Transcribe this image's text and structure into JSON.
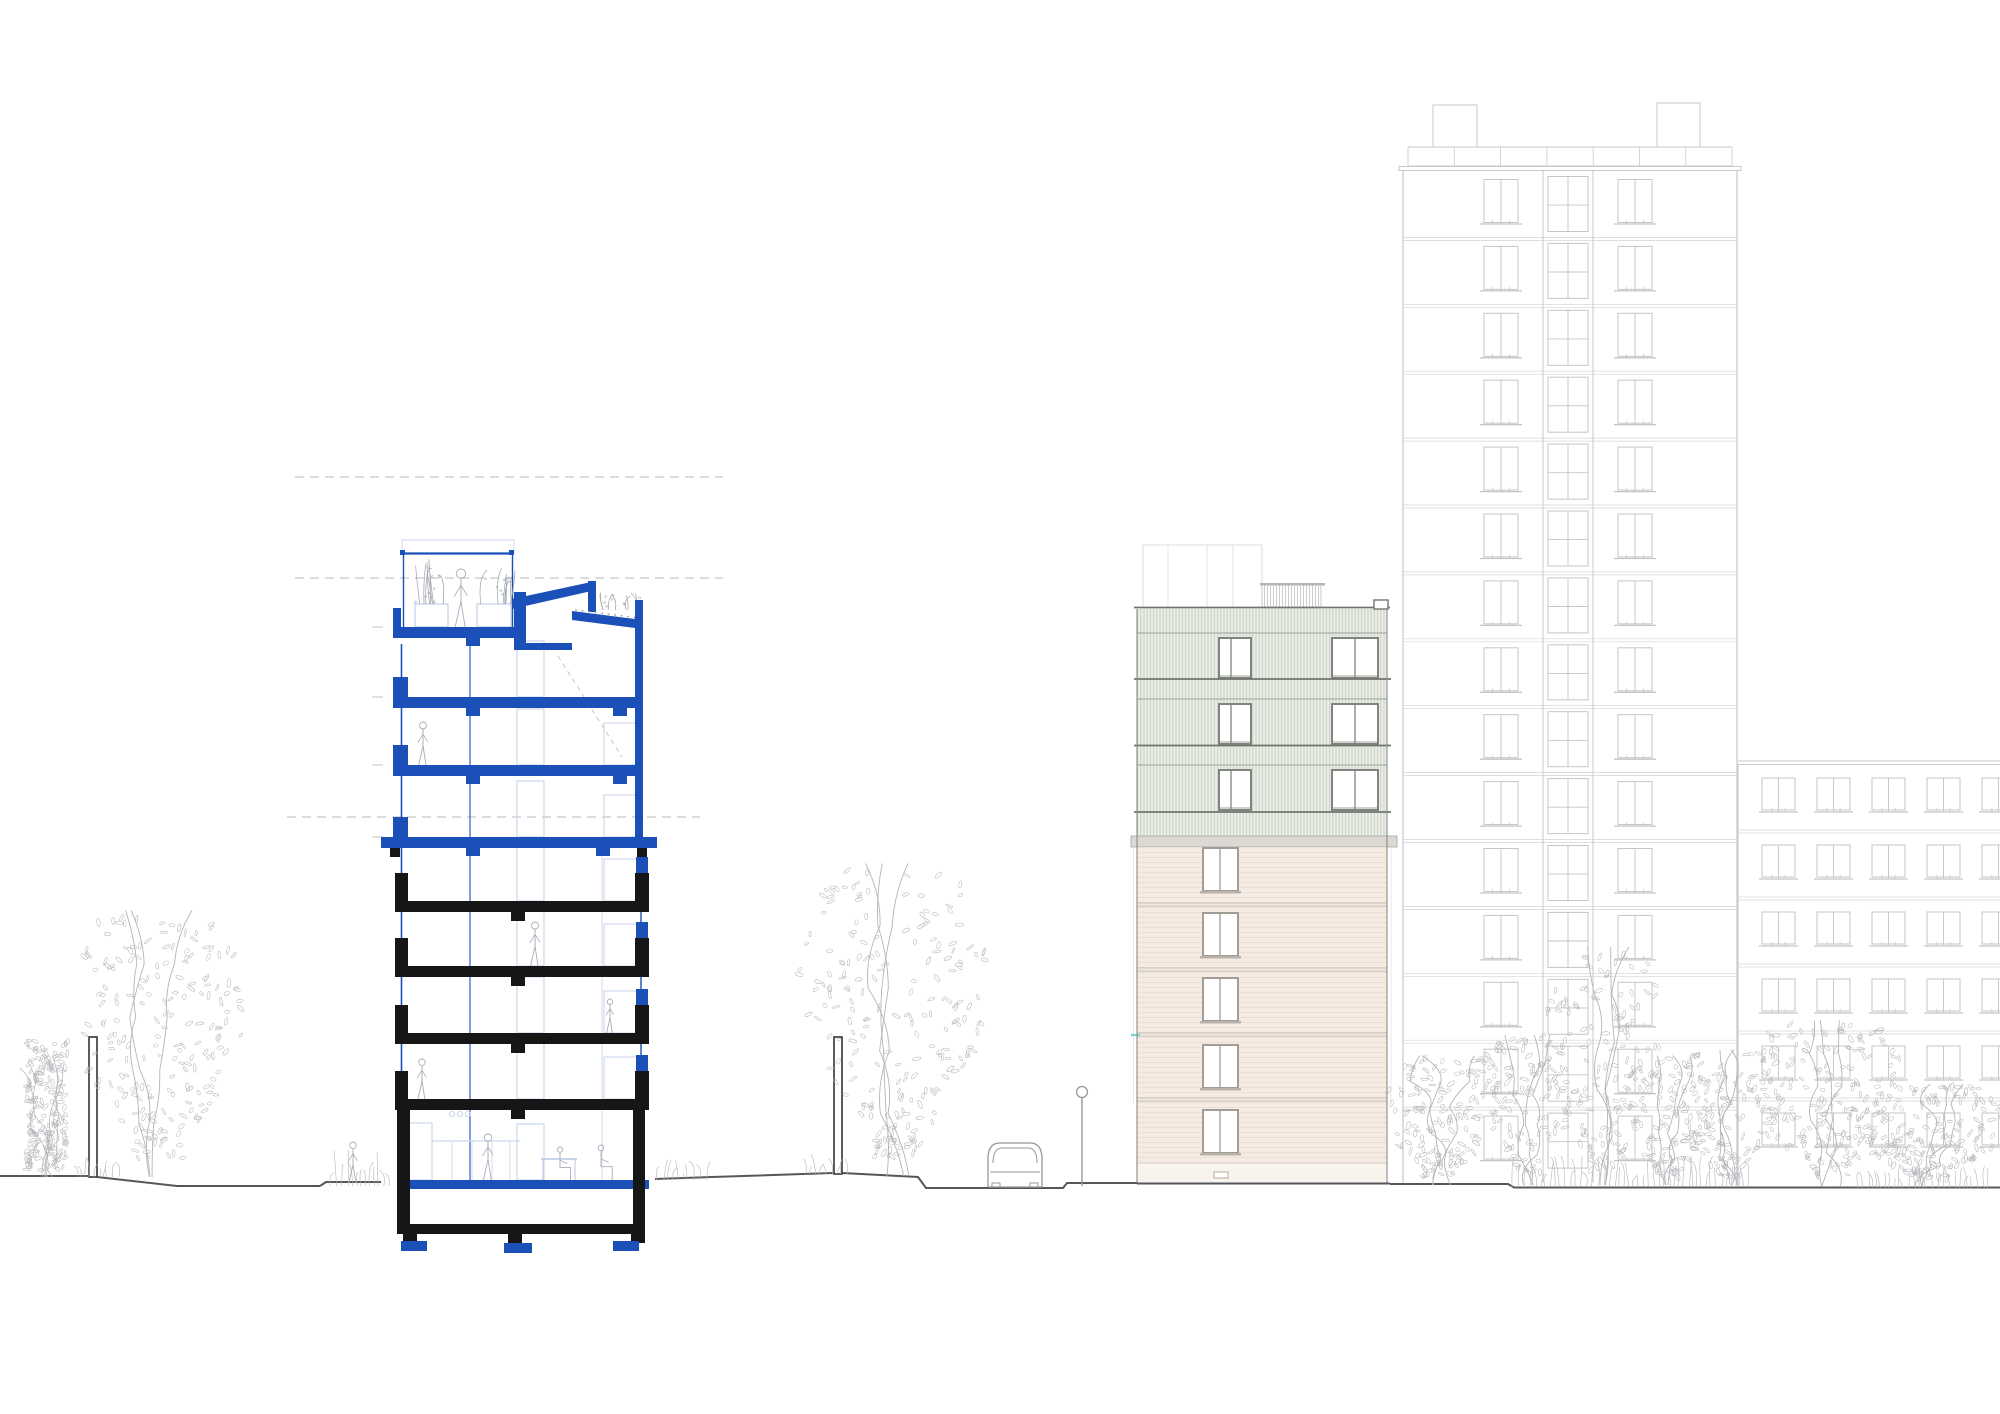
{
  "image": {
    "width": 2000,
    "height": 1414,
    "background": "#ffffff",
    "description": "Architectural drawing: residential cross-section (blue new floors over black existing floors) and street elevation with tower, extension building and landscape"
  },
  "palette": {
    "blue": "#1a50b8",
    "blueLight": "#ccd7ec",
    "blueMid": "#b9c6e0",
    "black": "#161616",
    "dash": "#c7c7c9",
    "tick": "#c3c3c5",
    "sketch": "#b2b5b9",
    "figure": "#a9aeb6",
    "ground": "#55575b",
    "post": "#3e4044",
    "vehicle": "#97989c",
    "towerLine": "#c9c9cd",
    "towerFloor": "#d4d4d8",
    "towerWin": "#c5c5c9",
    "greenFill": "#ecefe8",
    "greenHatch": "#c3cdbe",
    "greenLine": "#70746e",
    "greenHead": "#9ba199",
    "greenFrame": "#80847e",
    "beigeFill": "#f5ebe3",
    "beigeSiding": "#ebdfd5",
    "beigeFloor": "#c6c0b9",
    "beigeFrame": "#a29c96",
    "beigeSill": "#b8b2ab",
    "baseFill": "#f8f3ed",
    "baseLine": "#d8d2cb",
    "cornice": "#dcd8d3",
    "corniceEdge": "#a8a49f",
    "outline": "#8e8a85",
    "penthouse": "#c9c9cc",
    "faint": "#dddde0",
    "guide": "#e4e7ee",
    "cyan": "#7ed0cc"
  },
  "datum": {
    "lines": [
      {
        "y": 477,
        "x0": 295,
        "x1": 723
      },
      {
        "y": 578,
        "x0": 295,
        "x1": 723
      },
      {
        "y": 817,
        "x0": 287,
        "x1": 700
      }
    ],
    "ticks": {
      "x0": 372,
      "x1": 383,
      "ys": [
        627,
        697,
        765,
        837
      ]
    }
  },
  "section": {
    "left": 397,
    "right": 649,
    "slab_t": 11,
    "face_left_x": 401.5,
    "face_left_y": [
      644,
      1110
    ],
    "inner_blue_x": 470,
    "inner_blue_y": [
      638,
      1180
    ],
    "inner_light_x": 602,
    "inner_light_y": [
      848,
      1180
    ],
    "face_right_x": 641,
    "face_right_y": [
      848,
      1180
    ],
    "blue_slabs": [
      697,
      765
    ],
    "wide_blue_slab": [
      381,
      837,
      276,
      11
    ],
    "black_slabs": [
      901,
      966,
      1033,
      1099
    ],
    "interiors": [
      [
        644,
        697
      ],
      [
        708,
        765
      ],
      [
        776,
        837
      ],
      [
        848,
        901
      ],
      [
        912,
        966
      ],
      [
        977,
        1033
      ],
      [
        1044,
        1099
      ],
      [
        1110,
        1180
      ]
    ],
    "door": {
      "x": 517,
      "w": 27,
      "h": 56
    },
    "furniture": {
      "x": 604,
      "w": 36,
      "h": 42
    },
    "terrace": {
      "outline": [
        402,
        540,
        112,
        13
      ],
      "rail_y": 553.5,
      "rail_x": [
        402,
        514
      ],
      "posts": [
        [
          400,
          550
        ],
        [
          509,
          550
        ]
      ],
      "verticals": [
        403.5,
        512.5
      ],
      "vert_y": [
        555,
        627
      ],
      "slab": [
        393,
        627,
        124,
        11
      ],
      "upstand": [
        393,
        608,
        8,
        19
      ],
      "planters": [
        [
          415,
          604,
          33,
          23
        ],
        [
          477,
          604,
          34,
          23
        ]
      ],
      "plant_seed": 31
    },
    "bulkhead": {
      "wall": [
        514,
        592,
        12,
        58
      ],
      "roof": [
        [
          512,
          599
        ],
        [
          596,
          581
        ],
        [
          596,
          590
        ],
        [
          512,
          609
        ]
      ],
      "tab": [
        588,
        581,
        8,
        31
      ],
      "floor": [
        526,
        643,
        46,
        7
      ]
    },
    "green_roof": {
      "poly": [
        [
          572,
          611
        ],
        [
          643,
          620
        ],
        [
          643,
          629
        ],
        [
          572,
          620
        ]
      ],
      "parapet": [
        635,
        600,
        8,
        28
      ],
      "column": [
        635,
        612,
        8,
        236
      ],
      "plant_seed": 32
    },
    "under_terrace_stub": [
      466,
      638,
      14,
      8
    ],
    "blue_stub_x": [
      466,
      613
    ],
    "wide_slab_pads_black": [
      [
        390,
        848,
        10,
        9
      ],
      [
        637,
        848,
        10,
        9
      ]
    ],
    "wide_slab_stubs_blue": [
      [
        466,
        848,
        14,
        8
      ],
      [
        596,
        848,
        14,
        8
      ]
    ],
    "ground_slab": [
      397,
      1180,
      252,
      9
    ],
    "basement": {
      "lwall": [
        397,
        1110,
        13,
        123
      ],
      "rwall": [
        633,
        1110,
        12,
        123
      ],
      "slab": [
        397,
        1224,
        248,
        10
      ],
      "stubs": [
        [
          403,
          1233,
          14,
          10
        ],
        [
          508,
          1233,
          14,
          12
        ],
        [
          631,
          1233,
          14,
          10
        ]
      ],
      "pads": [
        [
          401,
          1241,
          26,
          10
        ],
        [
          504,
          1243,
          28,
          10
        ],
        [
          613,
          1241,
          26,
          10
        ]
      ]
    },
    "kitchen": {
      "fridge": [
        406,
        1123,
        26,
        57
      ],
      "counter_y": 1141,
      "counter_x": [
        432,
        520
      ],
      "verts": [
        452,
        472,
        492,
        510
      ],
      "circles": [
        [
          452,
          1114
        ],
        [
          460,
          1114
        ],
        [
          468,
          1114
        ]
      ],
      "table": {
        "x0": 541,
        "x1": 577,
        "y": 1159,
        "foot": 1181
      }
    },
    "stair_dash": [
      558,
      656,
      622,
      757
    ],
    "figures": [
      {
        "x": 461,
        "foot": 627,
        "h": 58
      },
      {
        "x": 423,
        "foot": 765,
        "h": 43
      },
      {
        "x": 535,
        "foot": 966,
        "h": 44
      },
      {
        "x": 610,
        "foot": 1033,
        "h": 34
      },
      {
        "x": 422,
        "foot": 1099,
        "h": 40
      },
      {
        "x": 488,
        "foot": 1180,
        "h": 46
      },
      {
        "x": 560,
        "foot": 1180,
        "h": 33,
        "sit": true
      },
      {
        "x": 601,
        "foot": 1180,
        "h": 35,
        "sit": true
      }
    ]
  },
  "midrise": {
    "x0": 1137,
    "x1": 1387,
    "ground": 1183,
    "rooftop_box": {
      "rect": [
        1143,
        545,
        119,
        63
      ],
      "verticals": [
        1168,
        1207,
        1233
      ]
    },
    "penthouse": {
      "rect": [
        1262,
        585,
        59,
        23
      ],
      "cap": [
        1260,
        583,
        65,
        2.5
      ]
    },
    "parapet": {
      "line_y": 607.5,
      "coping": [
        1374,
        600,
        14,
        9
      ]
    },
    "green": {
      "y0": 609,
      "y1": 836,
      "slab_lines": [
        679,
        745.5,
        812
      ],
      "head_lines": [
        633,
        699,
        765
      ],
      "window_rows": [
        638,
        704,
        770
      ],
      "win_h": 40,
      "windows": [
        {
          "x": 1219,
          "w": 32,
          "m": 12
        },
        {
          "x": 1332,
          "w": 46,
          "m": 23
        }
      ]
    },
    "cornice": [
      1131,
      836,
      266,
      11
    ],
    "beige": {
      "y0": 847,
      "rows": [
        848,
        913,
        978,
        1045,
        1110
      ],
      "win": [
        1203,
        35,
        43
      ],
      "mull": 17,
      "floor_lines": [
        903,
        968,
        1033,
        1098
      ],
      "base_y": 1163,
      "vent": [
        1214,
        1172,
        14,
        6
      ],
      "guide_x": [
        1133.5,
        1391
      ],
      "guide_y": [
        848,
        1103
      ],
      "cyan": [
        1131,
        1035,
        9
      ]
    }
  },
  "tower": {
    "x0": 1403,
    "x1": 1737,
    "ground": 1183,
    "parapet": {
      "y0": 147,
      "y1": 166,
      "step": 46.3,
      "rx0": 1408,
      "rx1": 1732
    },
    "roof_slab": [
      1399,
      166.5,
      342,
      4
    ],
    "boxes": [
      [
        1433,
        105,
        44,
        42
      ],
      [
        1657,
        103,
        43,
        44
      ]
    ],
    "floor_start": 170.5,
    "module": 66.9,
    "floors": 15,
    "shaft": {
      "x": 1543,
      "w": 50
    },
    "cols": [
      1484,
      1618
    ],
    "col_w": 34,
    "win_dy": 9,
    "win_h": 43
  },
  "neighbor": {
    "x0": 1738,
    "x1": 2000,
    "roof": [
      761,
      764.5
    ],
    "ground": 1187,
    "floor_lines": [
      830,
      897,
      964,
      1031,
      1098
    ],
    "rows": [
      778,
      845,
      912,
      979,
      1046,
      1113
    ],
    "cols": [
      1762,
      1817,
      1872,
      1927,
      1982
    ],
    "win_w": 33,
    "win_h": 32
  },
  "landscape": {
    "ground_paths": [
      [
        [
          0,
          1176
        ],
        [
          89,
          1176
        ]
      ],
      [
        [
          97,
          1177
        ],
        [
          177,
          1186
        ],
        [
          320,
          1186
        ]
      ],
      [
        [
          320,
          1186
        ],
        [
          326,
          1182
        ],
        [
          381,
          1182
        ]
      ],
      [
        [
          655,
          1179
        ],
        [
          712,
          1177
        ],
        [
          833,
          1173
        ]
      ],
      [
        [
          842,
          1173
        ],
        [
          918,
          1177
        ],
        [
          926,
          1188
        ],
        [
          1063,
          1188
        ],
        [
          1067,
          1183
        ],
        [
          1137,
          1183
        ]
      ],
      [
        [
          1137,
          1183.5
        ],
        [
          1390,
          1183.5
        ]
      ],
      [
        [
          1390,
          1184
        ],
        [
          1508,
          1184
        ],
        [
          1514,
          1187.5
        ],
        [
          2000,
          1187.5
        ]
      ]
    ],
    "posts": [
      [
        89,
        1037,
        8,
        140
      ],
      [
        834,
        1037,
        8,
        137
      ]
    ],
    "car": {
      "x": 988,
      "y": 1143,
      "w": 54,
      "h": 44
    },
    "lamp": {
      "x": 1082,
      "head_y": 1092,
      "r": 5.5,
      "ground": 1186
    },
    "people": [
      {
        "x": 353,
        "foot": 1183,
        "h": 41
      }
    ],
    "trees_back": [
      {
        "type": "bush",
        "cx": 47,
        "gy": 1177,
        "top": 1022,
        "spread": 72,
        "seed": 11
      },
      {
        "type": "tree",
        "cx": 158,
        "gy": 1177,
        "top": 905,
        "spread": 118,
        "seed": 2
      },
      {
        "type": "tree",
        "cx": 895,
        "gy": 1176,
        "top": 857,
        "spread": 128,
        "seed": 3
      }
    ],
    "trees_front": [
      {
        "type": "tree",
        "cx": 1440,
        "gy": 1185,
        "top": 1053,
        "spread": 85,
        "seed": 4
      },
      {
        "type": "tree",
        "cx": 1527,
        "gy": 1185,
        "top": 1032,
        "spread": 65,
        "seed": 5
      },
      {
        "type": "tree",
        "cx": 1604,
        "gy": 1185,
        "top": 942,
        "spread": 82,
        "seed": 6
      },
      {
        "type": "tree",
        "cx": 1668,
        "gy": 1185,
        "top": 1053,
        "spread": 60,
        "seed": 7
      },
      {
        "type": "tree",
        "cx": 1727,
        "gy": 1185,
        "top": 1047,
        "spread": 72,
        "seed": 8
      },
      {
        "type": "tree",
        "cx": 1827,
        "gy": 1186,
        "top": 1017,
        "spread": 105,
        "seed": 9
      },
      {
        "type": "tree",
        "cx": 1928,
        "gy": 1186,
        "top": 1082,
        "spread": 110,
        "seed": 10
      }
    ],
    "shrubs": [
      [
        78,
        122,
        1177,
        13,
        24
      ],
      [
        330,
        392,
        1186,
        24,
        25
      ],
      [
        657,
        712,
        1180,
        13,
        23
      ],
      [
        806,
        852,
        1174,
        15,
        26
      ],
      [
        1512,
        1748,
        1187,
        20,
        21
      ],
      [
        1858,
        1988,
        1188,
        14,
        22
      ]
    ]
  }
}
